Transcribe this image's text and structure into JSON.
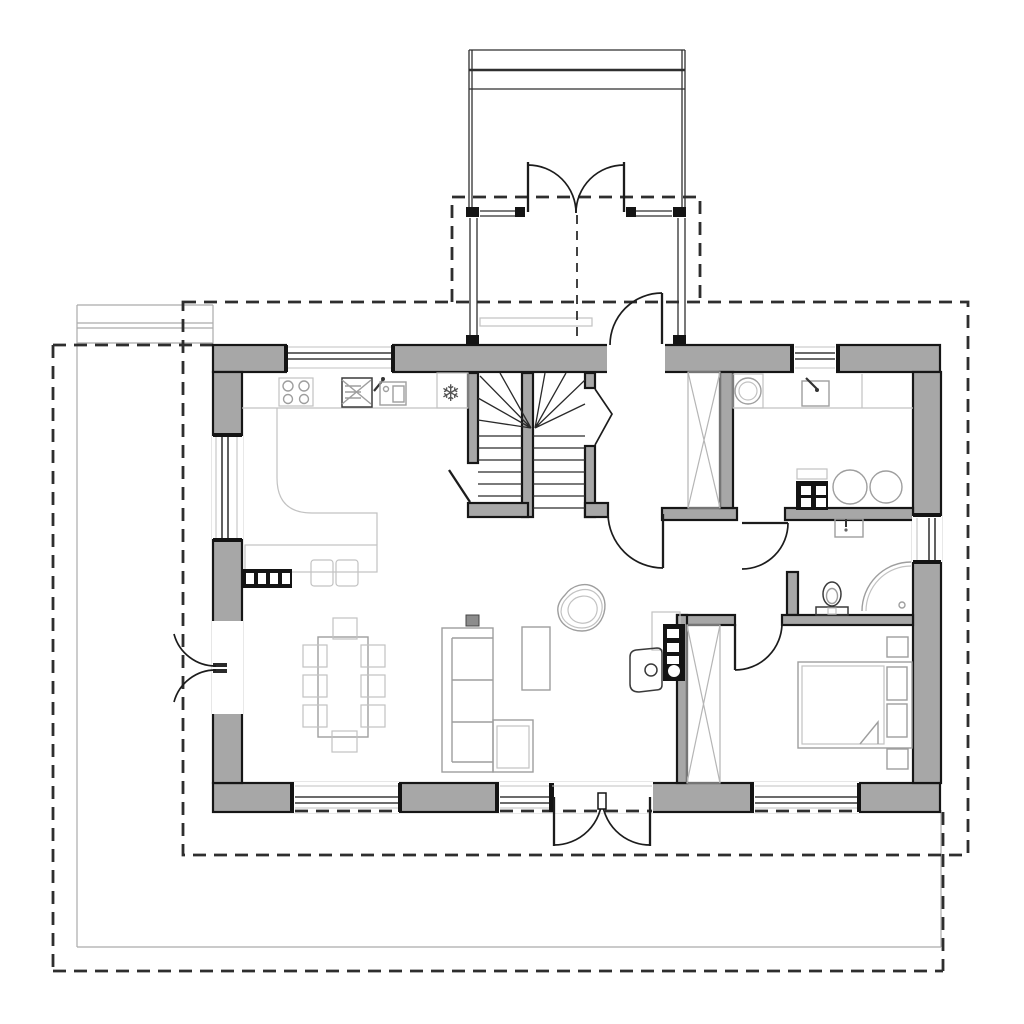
{
  "colors": {
    "background": "#ffffff",
    "wall-fill": "#a7a7a7",
    "wall-stroke": "#161616",
    "black-fill": "#141414",
    "dash": "#2e2e2e",
    "door": "#1c1c1c",
    "furniture": "#9e9e9e",
    "furniture-faint": "#c2c2c2",
    "fixture-dark": "#3a3a3a",
    "plot-line": "#ababab",
    "tread": "#2a2a2a"
  },
  "glyphs": {
    "snowflake": "❄"
  }
}
